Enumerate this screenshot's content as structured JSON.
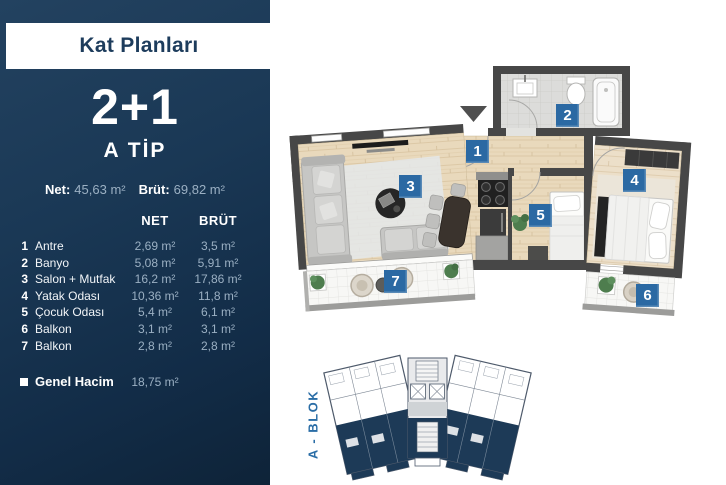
{
  "sidebar": {
    "title": "Kat Planları",
    "type_number": "2+1",
    "type_name": "A TİP",
    "summary": {
      "net_label": "Net:",
      "net_value": "45,63 m²",
      "brut_label": "Brüt:",
      "brut_value": "69,82 m²"
    },
    "table": {
      "net_header": "NET",
      "brut_header": "BRÜT",
      "rows": [
        {
          "num": "1",
          "name": "Antre",
          "net": "2,69 m²",
          "brut": "3,5 m²"
        },
        {
          "num": "2",
          "name": "Banyo",
          "net": "5,08 m²",
          "brut": "5,91 m²"
        },
        {
          "num": "3",
          "name": "Salon + Mutfak",
          "net": "16,2 m²",
          "brut": "17,86 m²"
        },
        {
          "num": "4",
          "name": "Yatak Odası",
          "net": "10,36 m²",
          "brut": "11,8 m²"
        },
        {
          "num": "5",
          "name": "Çocuk Odası",
          "net": "5,4 m²",
          "brut": "6,1 m²"
        },
        {
          "num": "6",
          "name": "Balkon",
          "net": "3,1 m²",
          "brut": "3,1 m²"
        },
        {
          "num": "7",
          "name": "Balkon",
          "net": "2,8 m²",
          "brut": "2,8 m²"
        }
      ]
    },
    "total": {
      "label": "Genel Hacim",
      "value": "18,75 m²"
    }
  },
  "plan": {
    "room_numbers": [
      "1",
      "2",
      "3",
      "4",
      "5",
      "6",
      "7"
    ],
    "block_label": "A - BLOK",
    "colors": {
      "badge_blue": "#2b69a3",
      "sidebar_navy": "#16314d",
      "keyplan_navy": "#1d3a57",
      "wall_gray": "#4a4a4a",
      "wood_floor": "#e9d9bc",
      "block_label_blue": "#2a6da6"
    }
  }
}
